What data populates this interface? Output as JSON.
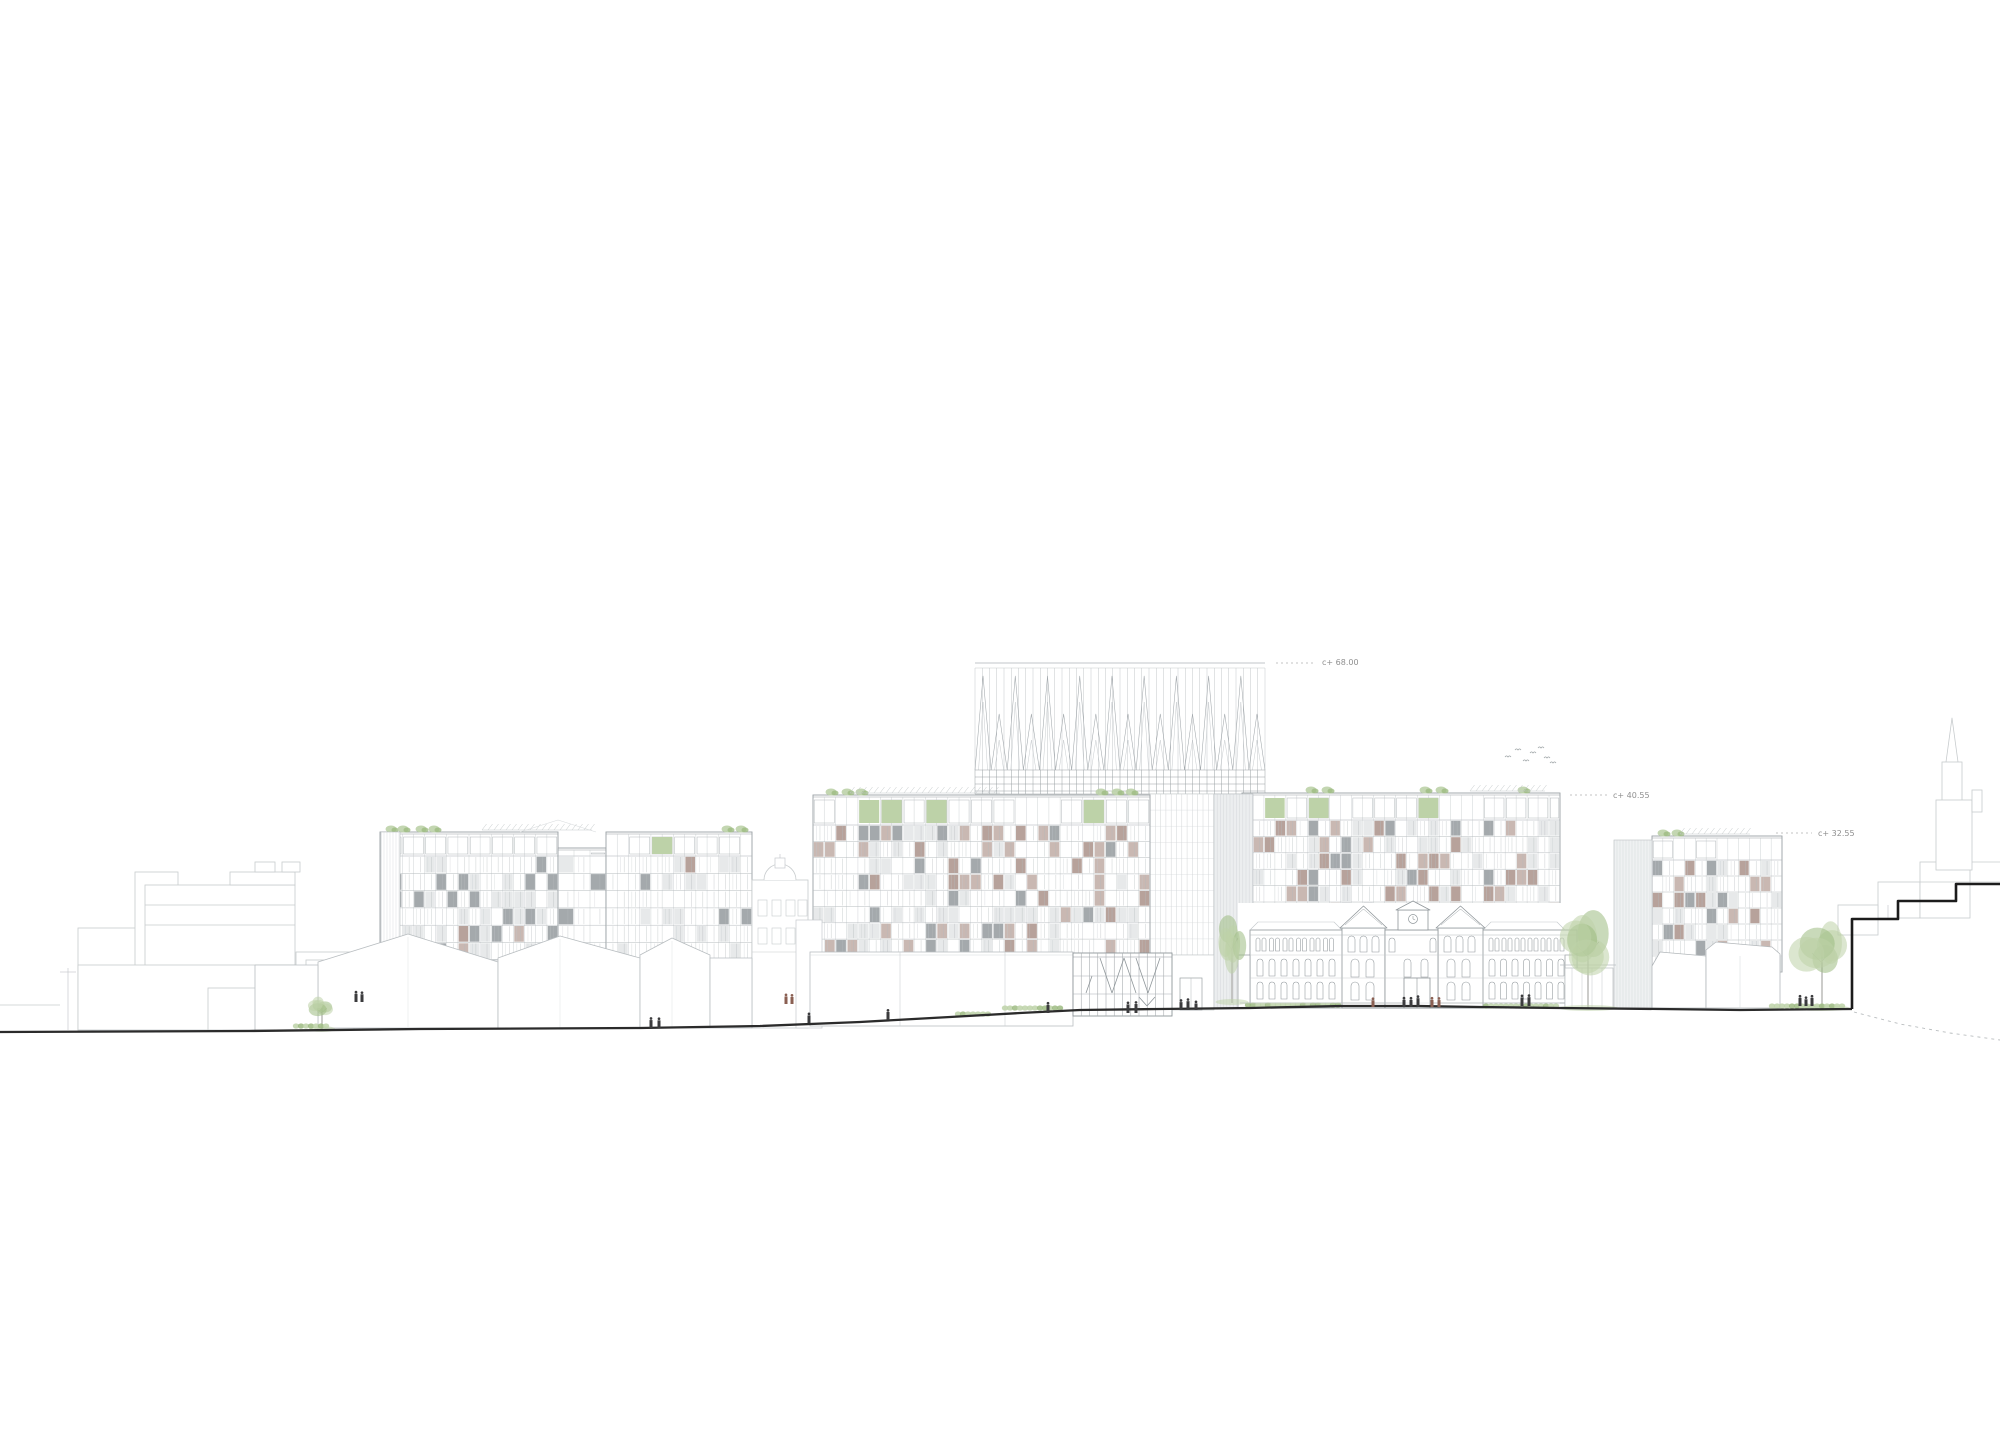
{
  "drawing": {
    "kind": "architectural street elevation",
    "background": "#ffffff"
  },
  "annotations": {
    "a68": {
      "label": "c+ 68.00",
      "x": 1322,
      "y": 665,
      "dash_x1": 1276,
      "dash_x2": 1314,
      "dash_y": 663
    },
    "a40": {
      "label": "c+ 40.55",
      "x": 1613,
      "y": 798,
      "dash_x1": 1570,
      "dash_x2": 1607,
      "dash_y": 795
    },
    "a32": {
      "label": "c+ 32.55",
      "x": 1818,
      "y": 836,
      "dash_x1": 1776,
      "dash_x2": 1812,
      "dash_y": 833
    }
  },
  "palette": {
    "line_light": "#c7cbcd",
    "line_mid": "#adb3b6",
    "line_dark": "#8f969a",
    "ground": "#2b2b2b",
    "steps": "#1c1c1c",
    "panel_mauve": "#b7a29b",
    "panel_mauve2": "#c9b8b2",
    "panel_gray": "#a4a9ac",
    "panel_light": "#e7e9ea",
    "louver_fill": "#eff1f2",
    "green1": "#bdd2a8",
    "green2": "#9dbb82",
    "green3": "#85a768",
    "figure_dark": "#3b3b3d",
    "figure_red": "#8a5f52",
    "annotation_text": "#8f8f8f",
    "white": "#ffffff"
  },
  "scene": {
    "canvas": {
      "w": 2000,
      "h": 1437
    },
    "blocks": [
      {
        "id": "block-a-left",
        "x": 380,
        "w": 178,
        "top": 832,
        "band": 24,
        "floors": 6,
        "fh": 17.3,
        "cols": 16,
        "mauve": 0.02,
        "gray": 0.13,
        "light": 0.22,
        "green": 0.05,
        "tufts": [
          391,
          403,
          421,
          434
        ]
      },
      {
        "id": "block-a-link",
        "x": 558,
        "w": 48,
        "top": 848,
        "band": 8,
        "floors": 6,
        "fh": 17.3,
        "cols": 3,
        "mauve": 0,
        "gray": 0.04,
        "light": 0.1,
        "green": 0,
        "tufts": []
      },
      {
        "id": "block-a-right",
        "x": 606,
        "w": 146,
        "top": 832,
        "band": 24,
        "floors": 6,
        "fh": 17.3,
        "cols": 13,
        "mauve": 0.02,
        "gray": 0.13,
        "light": 0.22,
        "green": 0.04,
        "tufts": [
          727,
          741
        ]
      },
      {
        "id": "block-b",
        "x": 813,
        "w": 337,
        "top": 795,
        "band": 30,
        "floors": 8,
        "fh": 16.3,
        "cols": 30,
        "mauve": 0.16,
        "gray": 0.09,
        "light": 0.2,
        "green": 0.05,
        "tufts": [
          831,
          847,
          861,
          1101,
          1117,
          1131
        ]
      },
      {
        "id": "block-c",
        "x": 1242,
        "w": 318,
        "top": 793,
        "band": 27,
        "floors": 11,
        "fh": 16.4,
        "cols": 29,
        "mauve": 0.15,
        "gray": 0.09,
        "light": 0.2,
        "green": 0.05,
        "tufts": [
          1311,
          1327,
          1425,
          1441,
          1523
        ]
      },
      {
        "id": "block-d",
        "x": 1652,
        "w": 130,
        "top": 836,
        "band": 24,
        "floors": 7,
        "fh": 16.0,
        "cols": 12,
        "mauve": 0.15,
        "gray": 0.1,
        "light": 0.2,
        "green": 0.05,
        "tufts": [
          1663,
          1677
        ]
      }
    ],
    "pergolas": [
      {
        "x1": 482,
        "x2": 592,
        "y": 830
      },
      {
        "x1": 850,
        "x2": 1000,
        "y": 793
      },
      {
        "x1": 1470,
        "x2": 1545,
        "y": 791
      },
      {
        "x1": 1680,
        "x2": 1750,
        "y": 834
      }
    ],
    "louvers": [
      {
        "x": 381,
        "y": 832,
        "w": 19,
        "h": 126,
        "pitch": 3,
        "fill": "#ffffff"
      },
      {
        "x": 1614,
        "y": 840,
        "w": 38,
        "h": 168,
        "pitch": 3,
        "fill": "#eff1f2"
      },
      {
        "x": 1214,
        "y": 794,
        "w": 39,
        "h": 214,
        "pitch": 3.2,
        "fill": "#eceeef"
      }
    ],
    "tower": {
      "x1": 975,
      "x2": 1265,
      "topline": 663,
      "topline2": 668,
      "spike_base": 770,
      "band_rows": [
        770,
        777,
        784,
        791,
        794
      ],
      "spikes": 18,
      "tall_apex": 676,
      "short_apex": 714,
      "v_pitch": 7.25,
      "shaft": {
        "x": 1150,
        "w": 64,
        "y": 794,
        "h": 161,
        "pitch": 5.3,
        "fh": 16.1
      },
      "base_wall": {
        "x": 1150,
        "w": 64,
        "y": 955,
        "h": 55,
        "door_x": 1180,
        "door_w": 22,
        "door_y": 978
      }
    },
    "pavilion": {
      "x": 1073,
      "w": 99,
      "top": 953,
      "base": 1016,
      "cols": 12,
      "bands": [
        976,
        994
      ],
      "diagonals": [
        [
          1100,
          958,
          1112,
          993
        ],
        [
          1124,
          958,
          1112,
          993
        ],
        [
          1124,
          958,
          1136,
          993
        ],
        [
          1160,
          958,
          1148,
          993
        ],
        [
          1136,
          958,
          1148,
          993
        ],
        [
          1092,
          976,
          1086,
          993
        ],
        [
          1139,
          997,
          1147,
          1006
        ],
        [
          1155,
          997,
          1147,
          1006
        ]
      ]
    },
    "podium": {
      "x": 810,
      "w": 263,
      "top": 952,
      "base": 1026,
      "joints": [
        900,
        1005
      ]
    },
    "school": {
      "x": 1238,
      "w": 339,
      "wing_top": 930,
      "base": 1008,
      "left_pav": {
        "x": 1342,
        "w": 43
      },
      "right_pav": {
        "x": 1438,
        "w": 45
      },
      "center": {
        "x": 1385,
        "w": 53,
        "gable_x": 1398,
        "gable_w": 30,
        "gable_top": 910,
        "clock_cx": 1413,
        "clock_cy": 919
      }
    },
    "cupola_building": {
      "x": 752,
      "w": 56,
      "top": 880,
      "dome_r": 16
    },
    "halls": [
      {
        "pts": [
          [
            318,
            1028
          ],
          [
            318,
            962
          ],
          [
            408,
            934
          ],
          [
            498,
            962
          ],
          [
            498,
            1028
          ]
        ],
        "ridge": [
          408,
          934
        ]
      },
      {
        "pts": [
          [
            498,
            1028
          ],
          [
            498,
            958
          ],
          [
            560,
            936
          ],
          [
            640,
            958
          ],
          [
            640,
            1028
          ]
        ],
        "ridge": [
          560,
          936
        ]
      },
      {
        "pts": [
          [
            640,
            1028
          ],
          [
            640,
            955
          ],
          [
            672,
            938
          ],
          [
            710,
            955
          ],
          [
            710,
            1028
          ]
        ],
        "ridge": [
          672,
          938
        ]
      },
      {
        "pts": [
          [
            710,
            1028
          ],
          [
            710,
            958
          ],
          [
            752,
            958
          ],
          [
            752,
            1028
          ]
        ],
        "ridge": null
      },
      {
        "pts": [
          [
            255,
            1030
          ],
          [
            255,
            965
          ],
          [
            318,
            965
          ],
          [
            318,
            1030
          ]
        ],
        "ridge": null
      }
    ],
    "context_left": {
      "rects": [
        [
          78,
          928,
          67,
          102
        ],
        [
          135,
          872,
          43,
          158
        ],
        [
          145,
          885,
          150,
          100
        ],
        [
          230,
          872,
          65,
          13
        ],
        [
          255,
          862,
          20,
          10
        ],
        [
          282,
          862,
          18,
          10
        ],
        [
          78,
          965,
          232,
          65
        ],
        [
          208,
          988,
          60,
          42
        ],
        [
          296,
          952,
          58,
          78
        ],
        [
          306,
          960,
          18,
          12
        ],
        [
          330,
          960,
          16,
          12
        ]
      ],
      "lines": [
        [
          145,
          905,
          295,
          905
        ],
        [
          145,
          925,
          295,
          925
        ],
        [
          68,
          968,
          68,
          1030
        ],
        [
          60,
          972,
          76,
          972
        ],
        [
          0,
          1005,
          60,
          1005
        ]
      ]
    },
    "context_right": {
      "rects": [
        [
          1878,
          882,
          42,
          36
        ],
        [
          1920,
          862,
          50,
          56
        ],
        [
          1838,
          905,
          40,
          30
        ]
      ],
      "lines": [
        [
          1888,
          905,
          1888,
          918
        ],
        [
          1920,
          882,
          2000,
          882
        ],
        [
          1970,
          862,
          2000,
          862
        ]
      ],
      "church": {
        "spire": [
          [
            1946,
            762
          ],
          [
            1952,
            718
          ],
          [
            1958,
            762
          ]
        ],
        "boxes": [
          [
            1942,
            762,
            20,
            40
          ],
          [
            1936,
            800,
            36,
            70
          ],
          [
            1972,
            790,
            10,
            22
          ]
        ]
      }
    },
    "kiosk": {
      "x": 1565,
      "y": 968,
      "w": 48,
      "h": 40,
      "posts": [
        1572,
        1582,
        1592,
        1602
      ],
      "roof": [
        1560,
        965,
        1616,
        965
      ]
    },
    "houses_right": [
      {
        "pts": [
          [
            1652,
            1008
          ],
          [
            1652,
            966
          ],
          [
            1660,
            952
          ],
          [
            1706,
            956
          ],
          [
            1706,
            1008
          ]
        ]
      },
      {
        "pts": [
          [
            1706,
            1008
          ],
          [
            1706,
            950
          ],
          [
            1716,
            942
          ],
          [
            1772,
            947
          ],
          [
            1780,
            954
          ],
          [
            1780,
            1008
          ]
        ],
        "joint": 1740
      }
    ],
    "steps_wall": [
      [
        1852,
        1009
      ],
      [
        1852,
        919
      ],
      [
        1898,
        919
      ],
      [
        1898,
        901
      ],
      [
        1956,
        901
      ],
      [
        1956,
        884
      ],
      [
        2000,
        884
      ]
    ],
    "ground": [
      [
        0,
        1032
      ],
      [
        250,
        1031
      ],
      [
        420,
        1029
      ],
      [
        640,
        1028
      ],
      [
        760,
        1026
      ],
      [
        860,
        1022
      ],
      [
        950,
        1017
      ],
      [
        1020,
        1013
      ],
      [
        1080,
        1010
      ],
      [
        1160,
        1009
      ],
      [
        1250,
        1008
      ],
      [
        1340,
        1006
      ],
      [
        1420,
        1006
      ],
      [
        1480,
        1007
      ],
      [
        1560,
        1008
      ],
      [
        1660,
        1009
      ],
      [
        1740,
        1010
      ],
      [
        1852,
        1009
      ]
    ],
    "ground_dashed": [
      [
        1854,
        1012
      ],
      [
        1900,
        1024
      ],
      [
        1950,
        1033
      ],
      [
        2000,
        1040
      ]
    ],
    "plinth_line": [
      1240,
      1003,
      1560,
      1003
    ],
    "trees": [
      {
        "cx": 322,
        "cy": 1008,
        "rx": 12,
        "ry": 13,
        "trunk_y": 1030
      },
      {
        "cx": 1232,
        "cy": 938,
        "rx": 15,
        "ry": 30,
        "trunk_y": 1003
      },
      {
        "cx": 1588,
        "cy": 942,
        "rx": 27,
        "ry": 38,
        "trunk_y": 1009
      },
      {
        "cx": 1822,
        "cy": 950,
        "rx": 25,
        "ry": 32,
        "trunk_y": 1009
      }
    ],
    "bushes": [
      [
        296,
        326,
        1026
      ],
      [
        958,
        992,
        1014
      ],
      [
        1005,
        1062,
        1008
      ],
      [
        1248,
        1338,
        1005
      ],
      [
        1486,
        1560,
        1006
      ],
      [
        1772,
        1846,
        1006
      ]
    ],
    "figures": [
      [
        356,
        1002,
        "d"
      ],
      [
        362,
        1002,
        "d"
      ],
      [
        651,
        1028,
        "d"
      ],
      [
        659,
        1028,
        "d"
      ],
      [
        786,
        1004,
        "r"
      ],
      [
        792,
        1004,
        "r"
      ],
      [
        809,
        1023,
        "d"
      ],
      [
        888,
        1020,
        "d"
      ],
      [
        1048,
        1013,
        "d"
      ],
      [
        1128,
        1013,
        "d"
      ],
      [
        1136,
        1013,
        "d"
      ],
      [
        1181,
        1010,
        "d"
      ],
      [
        1188,
        1010,
        "d"
      ],
      [
        1196,
        1010,
        "d"
      ],
      [
        1373,
        1007,
        "r"
      ],
      [
        1404,
        1007,
        "d"
      ],
      [
        1411,
        1007,
        "d"
      ],
      [
        1418,
        1007,
        "d"
      ],
      [
        1432,
        1007,
        "r"
      ],
      [
        1439,
        1007,
        "r"
      ],
      [
        1522,
        1006,
        "d"
      ],
      [
        1529,
        1006,
        "d"
      ],
      [
        1800,
        1006,
        "d"
      ],
      [
        1806,
        1006,
        "d"
      ],
      [
        1812,
        1006,
        "d"
      ]
    ],
    "birds": [
      [
        1508,
        757
      ],
      [
        1518,
        750
      ],
      [
        1526,
        761
      ],
      [
        1533,
        753
      ],
      [
        1541,
        748
      ],
      [
        1547,
        758
      ],
      [
        1553,
        763
      ]
    ]
  }
}
